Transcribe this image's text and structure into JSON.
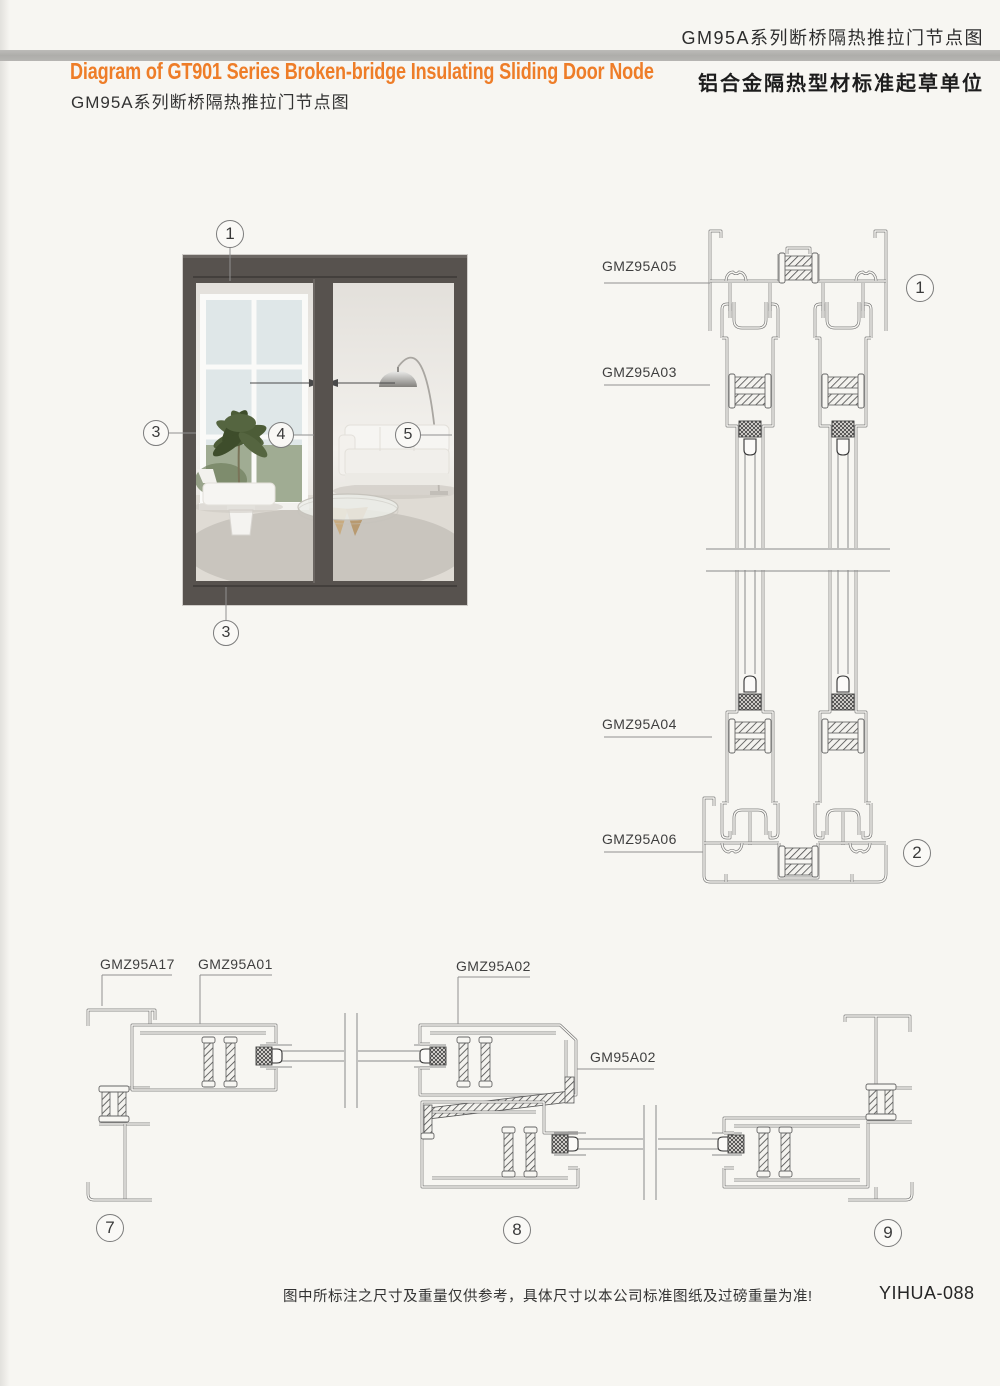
{
  "page": {
    "background": "#f7f6f2",
    "accent_orange": "#ee7d28",
    "bar_gray": "#b2b1ae"
  },
  "header": {
    "doc_title_cn": "GM95A系列断桥隔热推拉门节点图",
    "org_line_cn": "铝合金隔热型材标准起草单位",
    "title_en": "Diagram of GT901 Series Broken-bridge Insulating Sliding Door Node",
    "subtitle_cn": "GM95A系列断桥隔热推拉门节点图"
  },
  "part_labels": {
    "a05": "GMZ95A05",
    "a03": "GMZ95A03",
    "a04": "GMZ95A04",
    "a06": "GMZ95A06",
    "a17": "GMZ95A17",
    "a01": "GMZ95A01",
    "a02": "GMZ95A02",
    "gm02": "GM95A02"
  },
  "callouts": {
    "photo_top": "1",
    "photo_left": "3",
    "photo_center": "4",
    "photo_right": "5",
    "photo_bottom": "3",
    "section_head": "1",
    "section_sill": "2",
    "plan_left": "7",
    "plan_center": "8",
    "plan_right": "9"
  },
  "footer": {
    "disclaimer": "图中所标注之尺寸及重量仅供参考，具体尺寸以本公司标准图纸及过磅重量为准!",
    "page_code": "YIHUA-088"
  }
}
